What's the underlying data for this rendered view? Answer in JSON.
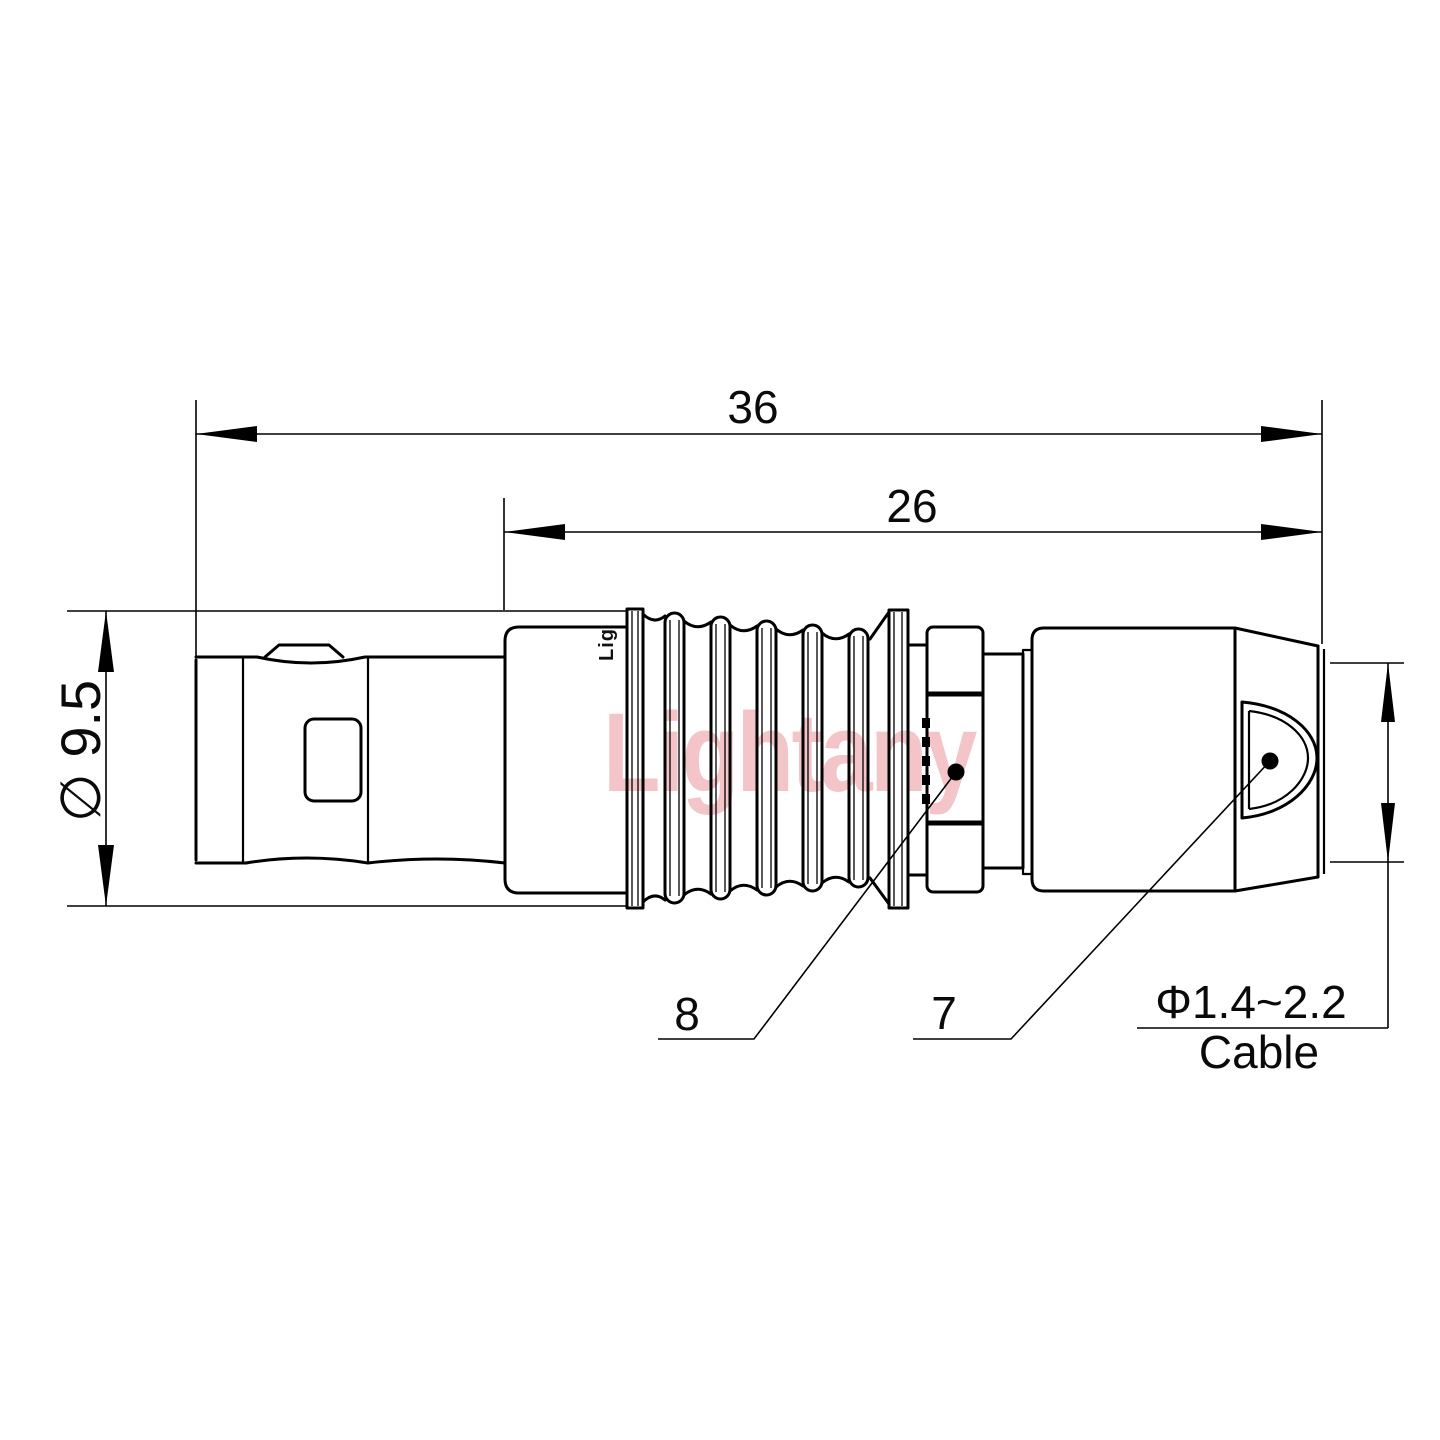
{
  "watermark": {
    "text": "Lightany"
  },
  "body_marking": {
    "text": "Lig"
  },
  "dimensions": {
    "overall_length": "36",
    "rear_length": "26",
    "front_diameter": "∅ 9.5",
    "cable_diameter": "Φ1.4~2.2",
    "cable_caption": "Cable"
  },
  "part_labels": {
    "strain_relief": "8",
    "cable_entry": "7"
  },
  "colors": {
    "line": "#000000",
    "text": "#0a0a0a",
    "watermark": "#efb0b5",
    "background": "#ffffff"
  }
}
